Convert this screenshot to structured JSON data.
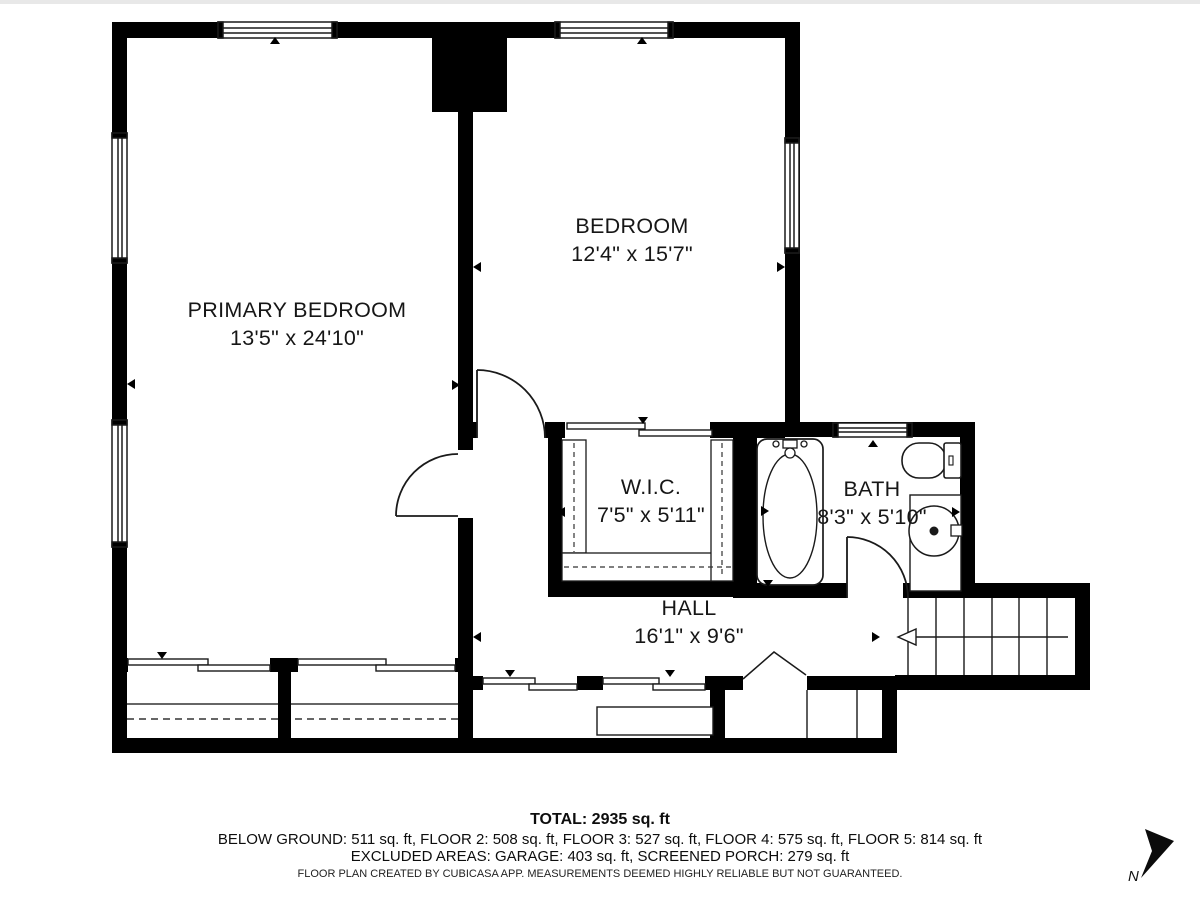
{
  "plan": {
    "rooms": [
      {
        "name": "PRIMARY BEDROOM",
        "dims": "13'5\" x 24'10\""
      },
      {
        "name": "BEDROOM",
        "dims": "12'4\" x 15'7\""
      },
      {
        "name": "W.I.C.",
        "dims": "7'5\" x 5'11\""
      },
      {
        "name": "BATH",
        "dims": "8'3\" x 5'10\""
      },
      {
        "name": "HALL",
        "dims": "16'1\" x 9'6\""
      }
    ],
    "compass": {
      "label": "N"
    }
  },
  "footer": {
    "total": "TOTAL: 2935 sq. ft",
    "floors": "BELOW GROUND: 511 sq. ft, FLOOR 2: 508 sq. ft, FLOOR 3: 527 sq. ft, FLOOR 4: 575 sq. ft, FLOOR 5: 814 sq. ft",
    "excluded": "EXCLUDED AREAS: GARAGE: 403 sq. ft, SCREENED PORCH: 279 sq. ft",
    "disclaimer": "FLOOR PLAN CREATED BY CUBICASA APP. MEASUREMENTS DEEMED HIGHLY RELIABLE BUT NOT GUARANTEED."
  },
  "colors": {
    "wall": "#000000",
    "background": "#ffffff",
    "thin_line": "#1a1a1a"
  }
}
